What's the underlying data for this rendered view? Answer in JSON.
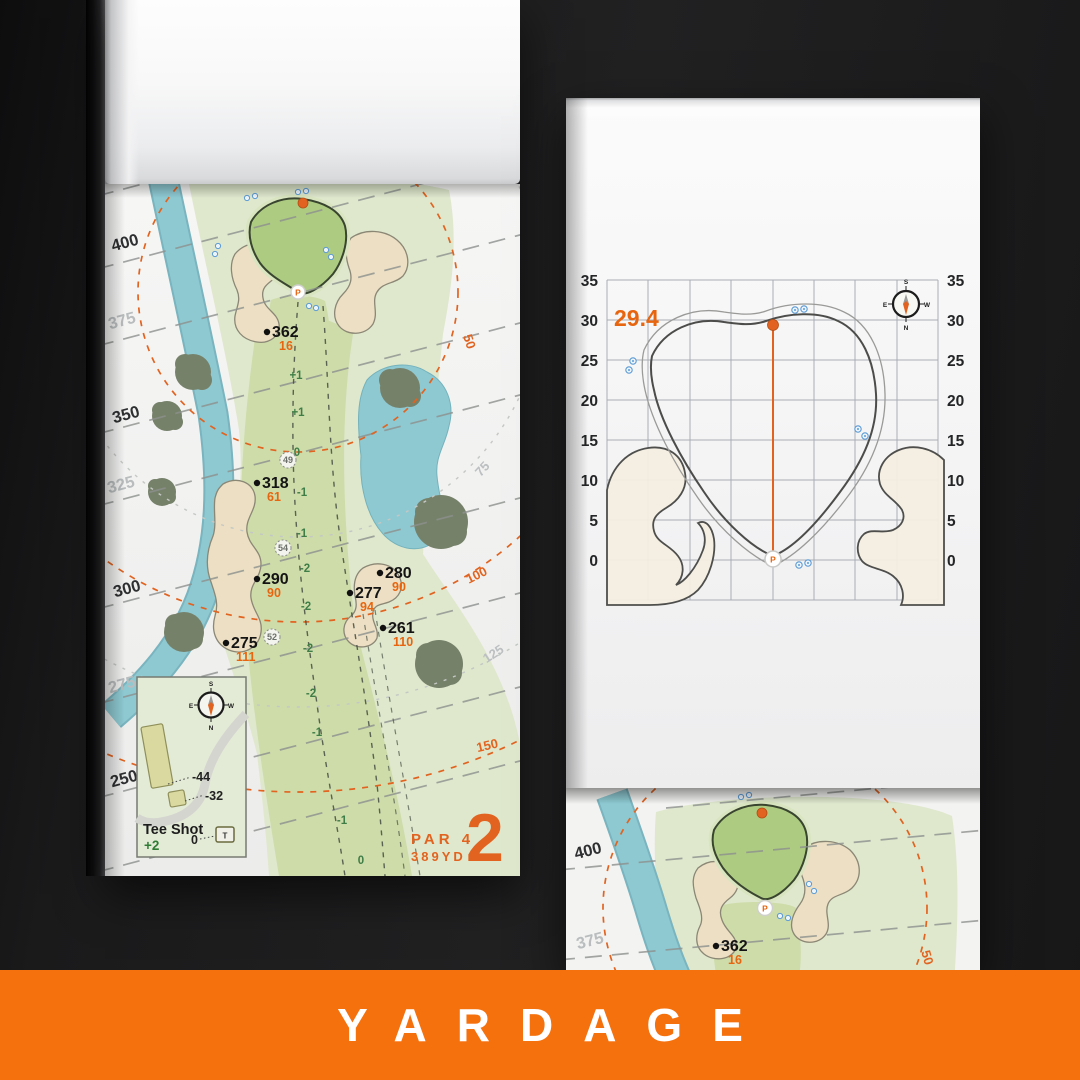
{
  "banner": {
    "label": "YARDAGE"
  },
  "colors": {
    "banner_orange": "#f5710e",
    "accent_orange": "#e8650f",
    "elevation_green": "#3f7d46",
    "water_blue": "#8ec9d2",
    "sand": "#ecdfc3"
  },
  "hole_page": {
    "hole_number": "2",
    "par_label": "PAR 4",
    "yardage_label": "389YD",
    "tee_distances": [
      "400",
      "375",
      "350",
      "325",
      "300",
      "275",
      "250"
    ],
    "ring_labels": [
      "50",
      "75",
      "100",
      "125",
      "150"
    ],
    "markers": [
      {
        "main": "362",
        "sub": "16"
      },
      {
        "main": "318",
        "sub": "61"
      },
      {
        "main": "290",
        "sub": "90"
      },
      {
        "main": "280",
        "sub": "90"
      },
      {
        "main": "277",
        "sub": "94"
      },
      {
        "main": "261",
        "sub": "110"
      },
      {
        "main": "275",
        "sub": "111"
      }
    ],
    "waypoints": [
      "49",
      "54",
      "52"
    ],
    "elevations": [
      "+1",
      "+1",
      "0",
      "-1",
      "-1",
      "-2",
      "-2",
      "-2",
      "-2",
      "-1",
      "-1",
      "0"
    ],
    "tee_box": {
      "title": "Tee Shot",
      "score": "+2",
      "zero_label": "0",
      "offset_long": "-44",
      "offset_short": "-32",
      "tee_letter": "T"
    },
    "compass": {
      "n": "N",
      "s": "S",
      "e": "E",
      "w": "W"
    },
    "pin_letter": "P"
  },
  "green_page": {
    "depth_value": "29.4",
    "tick_labels": [
      "35",
      "30",
      "25",
      "20",
      "15",
      "10",
      "5",
      "0"
    ],
    "pin_letter": "P",
    "compass": {
      "n": "N",
      "s": "S",
      "e": "E",
      "w": "W"
    }
  },
  "next_page": {
    "tee_distances": [
      "400",
      "375"
    ],
    "marker": {
      "main": "362",
      "sub": "16"
    },
    "ring_label": "50",
    "pin_letter": "P"
  }
}
